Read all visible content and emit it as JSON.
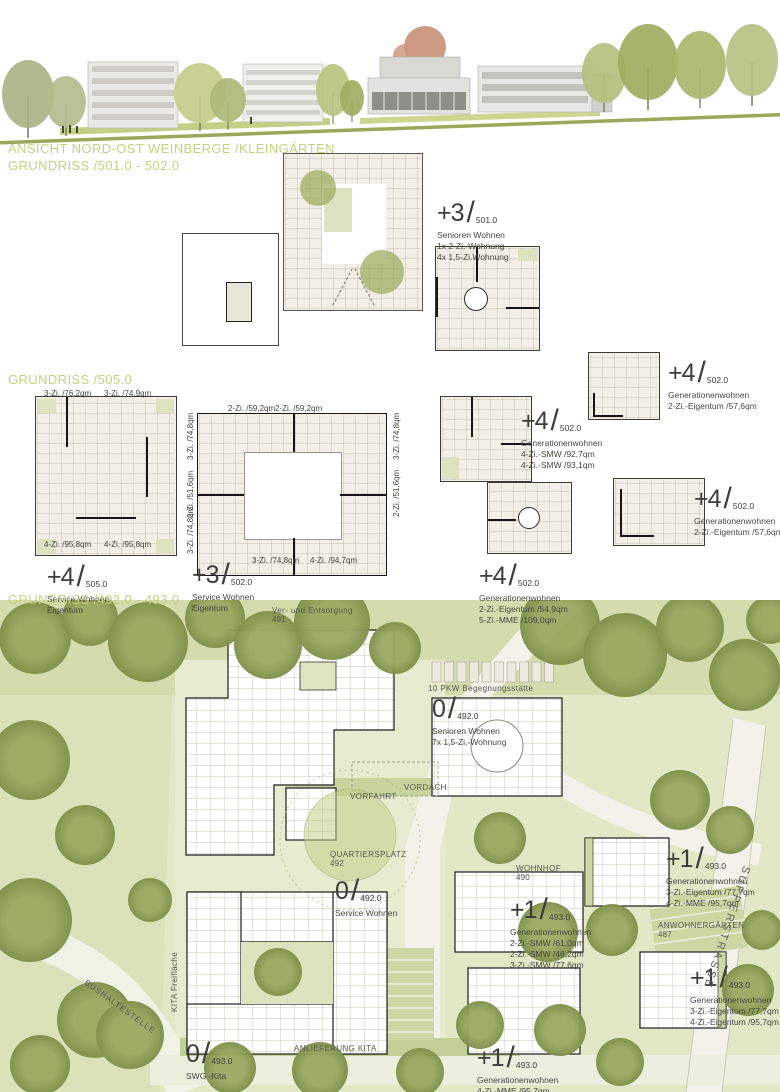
{
  "section_titles": {
    "elevation": "ANSICHT NORD-OST WEINBERGE /KLEINGÄRTEN",
    "plans_501_502": "GRUNDRISS /501.0 - 502.0",
    "plans_505": "GRUNDRISS /505.0",
    "site_492_493": "GRUNDRISS /492.0 - 493.0"
  },
  "glyphs": {
    "slash": "/"
  },
  "colors": {
    "title_green": "#c6d17f",
    "text_dark": "#3d3d3b",
    "site_green_light": "#e2e7c6",
    "site_green_band": "#c8d49e",
    "tree_olive": "#8e9d55",
    "plan_paper": "#f1efe6",
    "road_white": "#f2f2ea",
    "elevation_tree_red": "#c88f77"
  },
  "plan_labels": [
    {
      "level": "+3",
      "ref": "501.0",
      "lines": [
        "Senioren Wohnen",
        "1x 2-Zi.-Wohnung",
        "4x 1,5-Zi.Wohnung"
      ]
    },
    {
      "level": "+4",
      "ref": "502.0",
      "lines": [
        "Generationenwohnen",
        "2-Zi.-Eigentum /57,6qm"
      ]
    },
    {
      "level": "+4",
      "ref": "502.0",
      "lines": [
        "Generationenwohnen",
        "4-Zi.-SMW /92,7qm",
        "4-Zi.-SMW /93,1qm"
      ]
    },
    {
      "level": "+4",
      "ref": "502.0",
      "lines": [
        "Generationenwohnen",
        "2-Zi.-Eigentum /57,6qm"
      ]
    },
    {
      "level": "+4",
      "ref": "502.0",
      "lines": [
        "Generationenwohnen",
        "2-Zi.-Eigentum /54,9qm",
        "5-Zi.-MME /109,0qm"
      ]
    },
    {
      "level": "+4",
      "ref": "505.0",
      "lines": [
        "Service Wohnen",
        "Eigentum"
      ]
    },
    {
      "level": "+3",
      "ref": "502.0",
      "lines": [
        "Service Wohnen",
        "Eigentum"
      ]
    },
    {
      "level": "0",
      "ref": "492.0",
      "lines": [
        "Senioren Wohnen",
        "7x 1,5-Zi.-Wohnung"
      ]
    },
    {
      "level": "0",
      "ref": "492.0",
      "lines": [
        "Service Wohnen"
      ]
    },
    {
      "level": "+1",
      "ref": "493.0",
      "lines": [
        "Generationenwohnen",
        "3-Zi.-Eigentum /77,7qm",
        "4-Zi.-MME /95,7qm"
      ]
    },
    {
      "level": "+1",
      "ref": "493.0",
      "lines": [
        "Generationenwohnen",
        "2-Zi.-SMW /61,0qm",
        "2-Zi.-SMW /46,2qm",
        "3-Zi.-SMW /77,6qm"
      ]
    },
    {
      "level": "+1",
      "ref": "493.0",
      "lines": [
        "Generationenwohnen",
        "3-Zi.-Eigentum /77,7qm",
        "4-Zi.-Eigentum /95,7qm"
      ]
    },
    {
      "level": "+1",
      "ref": "493.0",
      "lines": [
        "Generationenwohnen",
        "4-Zi.-MME /95,7qm",
        "3-Zi.-MME /77,8qm"
      ]
    },
    {
      "level": "0",
      "ref": "493.0",
      "lines": [
        "SWG -Kita"
      ]
    }
  ],
  "unit_labels": [
    "3-Zi. /76,2qm",
    "3-Zi. /74,9qm",
    "4-Zi. /95,8qm",
    "4-Zi. /95,8qm",
    "2-Zi. /59,2qm",
    "2-Zi. /59,2qm",
    "3-Zi. /74,8qm",
    "4-Zi. /94,7qm",
    "3-Zi. /74,8qm",
    "2-Zi. /51,6qm",
    "3-Zi. /74,8qm",
    "3-Zi. /74,8qm",
    "2-Zi. /51,6qm"
  ],
  "site_labels": {
    "ver_und_entsorgung": "Ver- und Entsorgung",
    "ver_und_entsorgung_num": "491",
    "pkw": "10 PKW Begegnungsstätte",
    "vordach": "VORDACH",
    "vorfahrt": "VORFAHRT",
    "quartiersplatz": "QUARTIERSPLATZ",
    "quartiersplatz_num": "492",
    "wohnhof": "WOHNHOF",
    "wohnhof_num": "490",
    "anwohnergaerten": "ANWOHNERGÄRTEN",
    "anwohnergaerten_num": "487",
    "anlieferung_kita": "ANLIEFERUNG KITA",
    "bushaltestelle": "BUSHALTESTELLE",
    "kita_freiflaeche": "KITA Freifläche",
    "strasse": "SUPPERSTRASSE"
  }
}
